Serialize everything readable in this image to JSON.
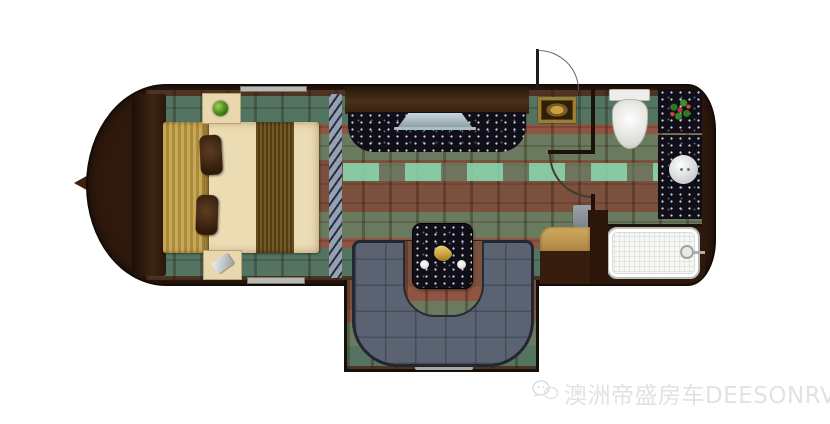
{
  "watermark": {
    "text": "澳洲帝盛房车DEESONRV",
    "logo_icon": "wechat-style-logo-icon"
  },
  "floorplan": {
    "type": "rv-caravan-top-down-floor-plan",
    "orientation": "hitch-left-front, rear-right",
    "rooms": [
      "bedroom",
      "galley-living-area",
      "dinette-slideout",
      "bathroom",
      "shower-rear"
    ],
    "features": [
      "tow-hitch",
      "master-bed",
      "bed-runner",
      "gold-blanket",
      "pillows",
      "nightstand-with-plant",
      "nightstand-with-book",
      "privacy-divider",
      "entertainment-cabinet",
      "granite-counter",
      "tv",
      "entry-door-with-swing-arc",
      "door-mat",
      "bathroom-door-arc",
      "toilet",
      "vanity-with-flowers",
      "round-sink",
      "shower-tray-with-drain",
      "u-shaped-dinette-sofa",
      "dinette-table-with-plates",
      "side-counter",
      "windows"
    ],
    "colors": {
      "background": "#ffffff",
      "body_wood": "#2f190d",
      "wall_outline": "#15100c",
      "rug_base": "#6d4c39",
      "rug_teal": "#527461",
      "rug_rust": "#8f5542",
      "rug_mint": "#88e6bc",
      "bed_linen": "#ecdcb4",
      "blanket_gold": "#c9a757",
      "pillow_brown": "#4a3120",
      "sofa_slate": "#5b6373",
      "granite_black": "#100e18",
      "fixture_white": "#f2f2ee",
      "counter_tan": "#c8a35c"
    }
  }
}
